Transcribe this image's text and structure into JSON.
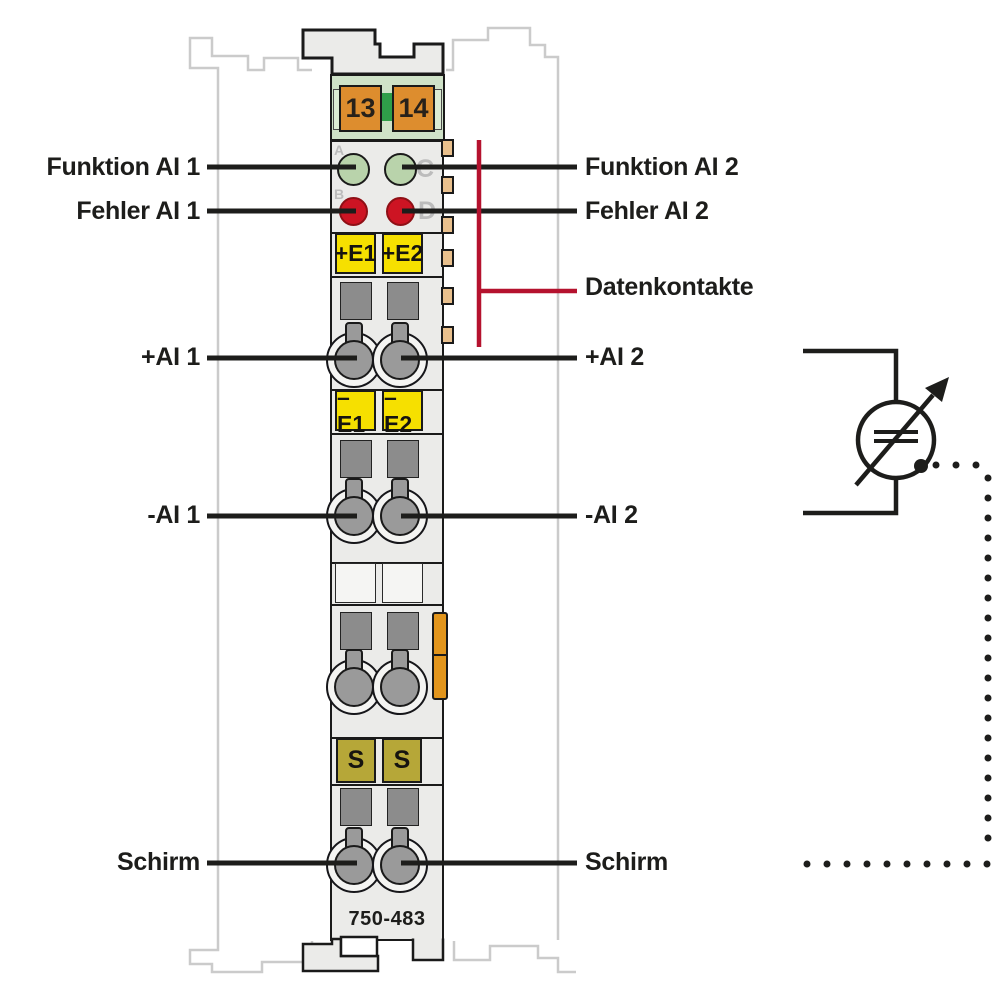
{
  "labels": {
    "funktion_ai1": "Funktion AI 1",
    "fehler_ai1": "Fehler AI 1",
    "plus_ai1": "+AI 1",
    "minus_ai1": "-AI 1",
    "schirm_left": "Schirm",
    "funktion_ai2": "Funktion AI 2",
    "fehler_ai2": "Fehler AI 2",
    "datenkontakte": "Datenkontakte",
    "plus_ai2": "+AI 2",
    "minus_ai2": "-AI 2",
    "schirm_right": "Schirm"
  },
  "module": {
    "part_number": "750-483",
    "power_contacts": {
      "left": "13",
      "right": "14"
    },
    "terminal_markers": {
      "plus_e1": "+E1",
      "plus_e2": "+E2",
      "minus_e1": "–E1",
      "minus_e2": "–E2",
      "shield_1": "S",
      "shield_2": "S"
    },
    "led_letters": {
      "a": "A",
      "b": "B",
      "c": "C",
      "d": "D"
    }
  },
  "colors": {
    "line_black": "#1d1d1b",
    "datenkontakte_red": "#b5122e",
    "led_green": "#b9d3ab",
    "led_red": "#cd1423",
    "power_contact_orange": "#dd8d2e",
    "marker_yellow": "#f6e000",
    "marker_olive": "#b6a738",
    "data_contact_tan": "#e9c08d",
    "release_latch_orange": "#e2951c",
    "header_green": "#cfe2c8",
    "housing_gray": "#ebebe9",
    "ghost_gray": "#cbcbcb"
  }
}
